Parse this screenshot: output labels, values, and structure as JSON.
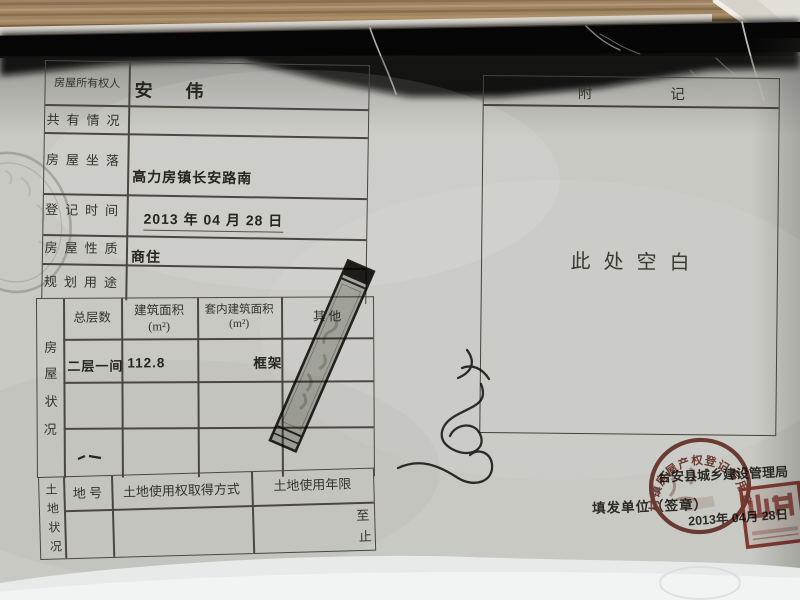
{
  "fields": [
    {
      "label": "房屋所有权人",
      "value": "安  伟"
    },
    {
      "label": "共有情况",
      "value": ""
    },
    {
      "label": "房屋坐落",
      "value": "高力房镇长安路南"
    },
    {
      "label": "登记时间",
      "value": "2013 年 04 月 28 日"
    },
    {
      "label": "房屋性质",
      "value": "商住"
    },
    {
      "label": "规划用途",
      "value": ""
    }
  ],
  "house_status": {
    "section_label_chars": [
      "房",
      "屋",
      "状",
      "况"
    ],
    "headers": [
      {
        "line1": "总层数",
        "line2": ""
      },
      {
        "line1": "建筑面积",
        "line2": "(m²)"
      },
      {
        "line1": "套内建筑面积",
        "line2": "(m²)"
      },
      {
        "line1": "其  他",
        "line2": ""
      }
    ],
    "row": {
      "floors": "二层一间",
      "area": "112.8",
      "inner_area": "",
      "other": "框架"
    }
  },
  "land_status": {
    "section_label_chars": [
      "土",
      "地",
      "状",
      "况"
    ],
    "headers": [
      "地  号",
      "土地使用权取得方式",
      "土地使用年限"
    ],
    "term_from": "至",
    "term_to": "止"
  },
  "remarks": {
    "title": "附记",
    "blank_text": "此处空白"
  },
  "footer": {
    "agency": "台安县城乡建设管理局",
    "issuer_label": "填发单位（签章）",
    "date": "2013年 04月 28日"
  },
  "seals": {
    "round_arc_text": "村镇房屋产权登记专用章",
    "seal_color": "#7c3a31"
  },
  "colors": {
    "paper": "#c8c9c3",
    "table_line": "#4a473f",
    "wood": "#9d8464",
    "copy_band": "#0c0c0c"
  }
}
